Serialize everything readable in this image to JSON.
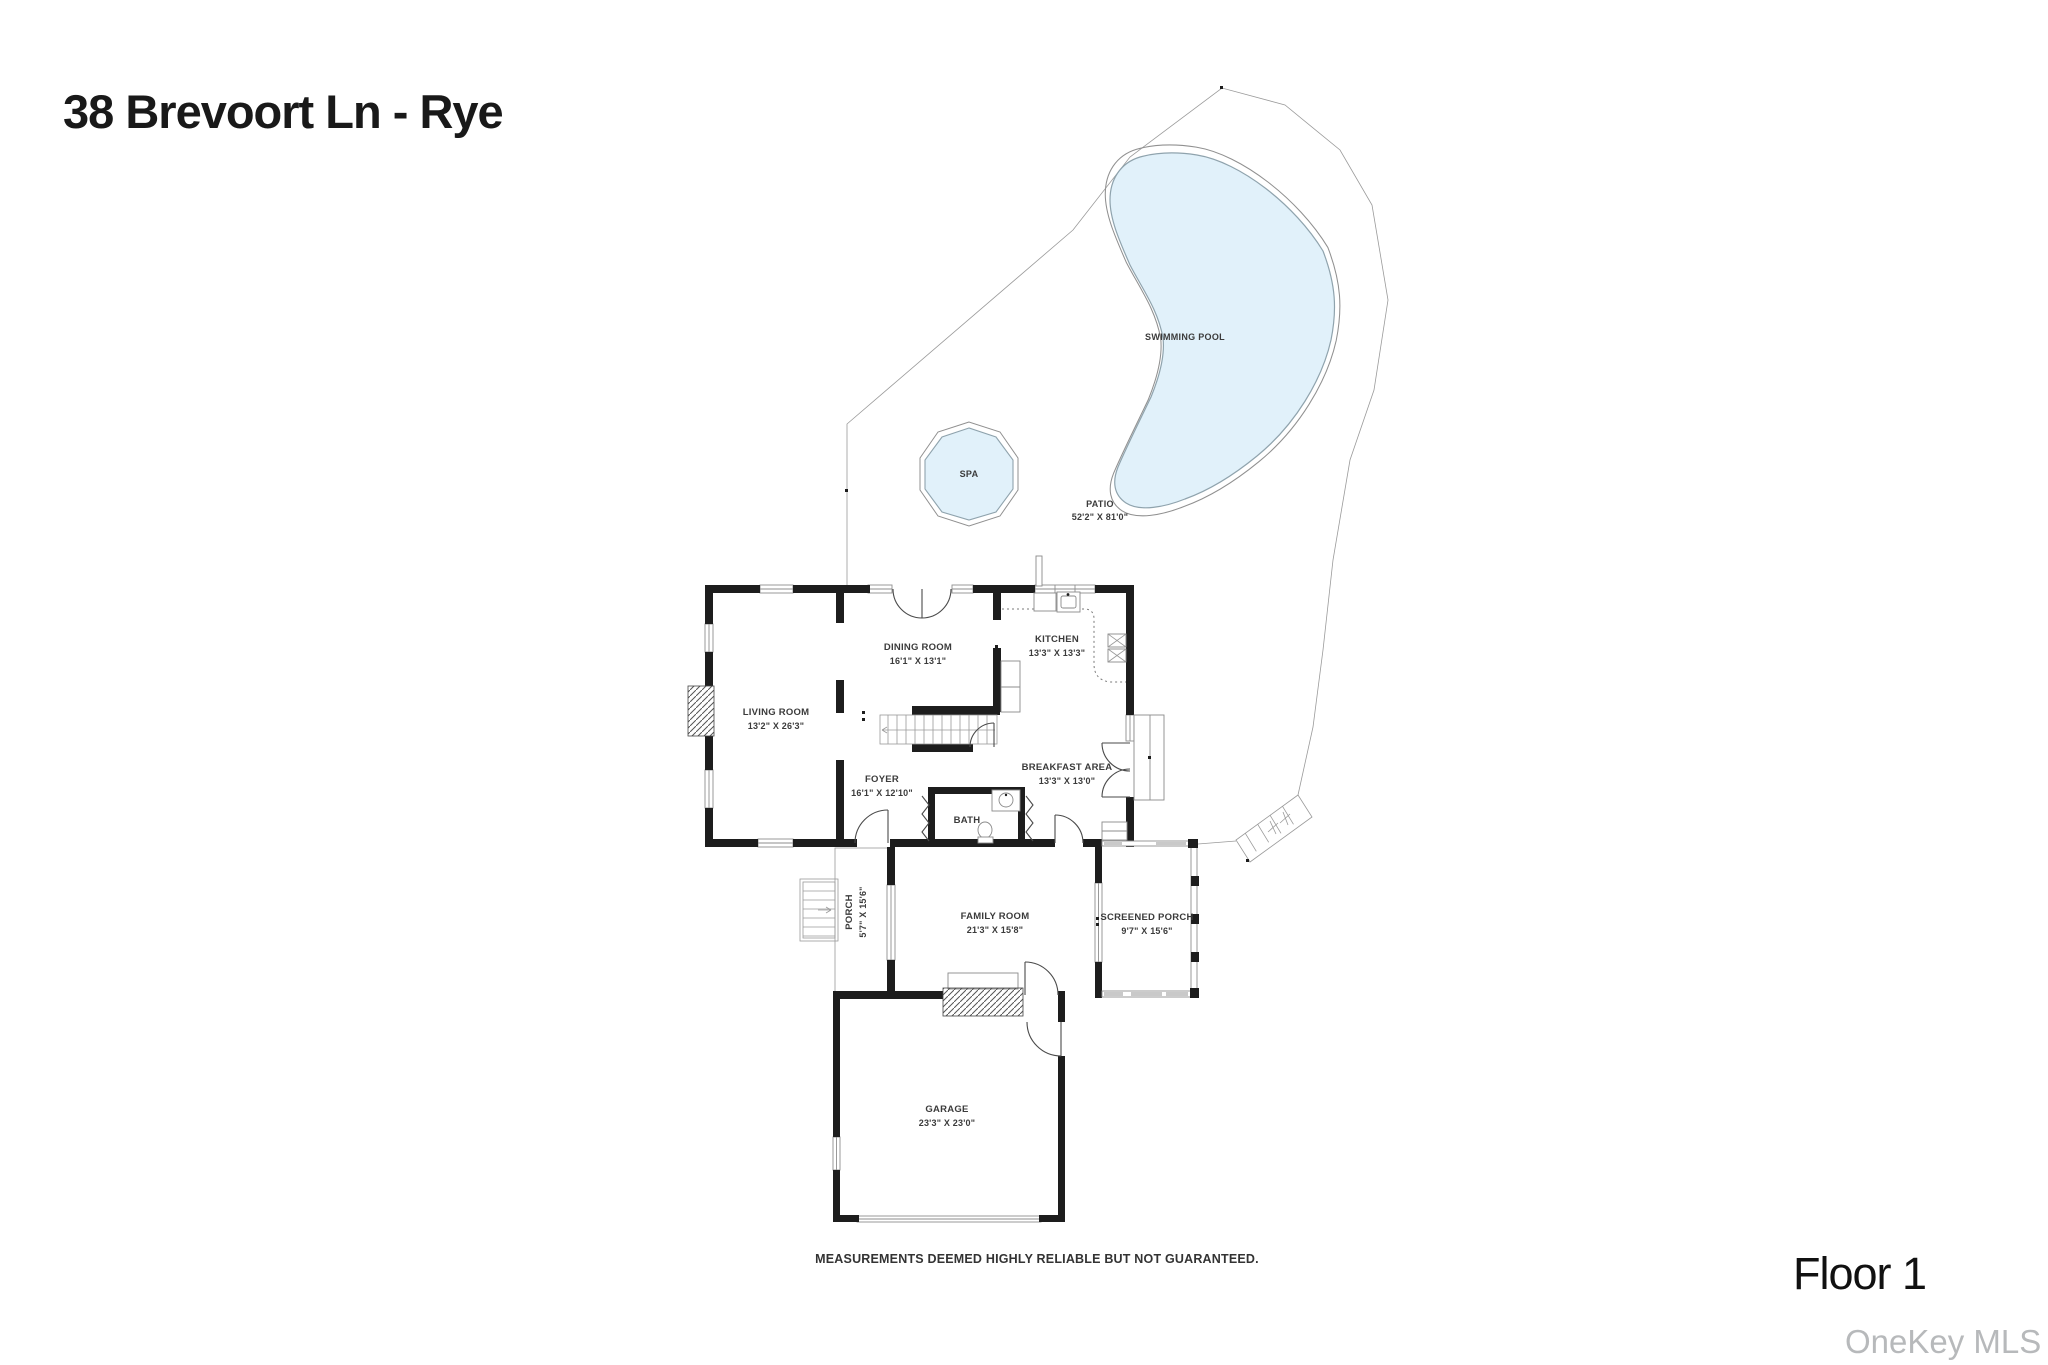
{
  "page": {
    "title": "38 Brevoort Ln - Rye",
    "floor_label": "Floor 1",
    "watermark": "OneKey MLS",
    "disclaimer": "MEASUREMENTS DEEMED HIGHLY RELIABLE BUT NOT GUARANTEED."
  },
  "outdoor": {
    "swimming_pool": {
      "label": "SWIMMING POOL"
    },
    "spa": {
      "label": "SPA"
    },
    "patio": {
      "label": "PATIO",
      "dimensions": "52'2\" X 81'0\""
    }
  },
  "rooms": {
    "living_room": {
      "label": "LIVING ROOM",
      "dimensions": "13'2\" X 26'3\""
    },
    "dining_room": {
      "label": "DINING ROOM",
      "dimensions": "16'1\" X 13'1\""
    },
    "kitchen": {
      "label": "KITCHEN",
      "dimensions": "13'3\" X 13'3\""
    },
    "foyer": {
      "label": "FOYER",
      "dimensions": "16'1\" X 12'10\""
    },
    "breakfast_area": {
      "label": "BREAKFAST AREA",
      "dimensions": "13'3\" X 13'0\""
    },
    "bath": {
      "label": "BATH"
    },
    "porch": {
      "label": "PORCH",
      "dimensions": "5'7\" X 15'6\""
    },
    "family_room": {
      "label": "FAMILY ROOM",
      "dimensions": "21'3\" X 15'8\""
    },
    "screened_porch": {
      "label": "SCREENED PORCH",
      "dimensions": "9'7\" X 15'6\""
    },
    "garage": {
      "label": "GARAGE",
      "dimensions": "23'3\" X 23'0\""
    }
  },
  "colors": {
    "pool_fill": "#e1f1fa",
    "wall": "#1d1d1d",
    "outline": "#909090",
    "watermark": "#b7b9bb"
  }
}
